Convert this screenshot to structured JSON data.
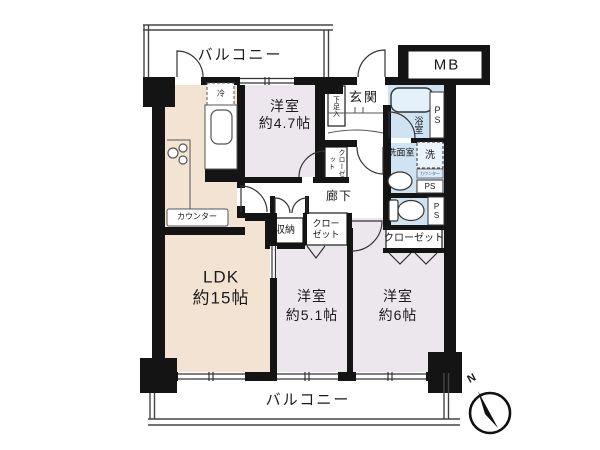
{
  "floorplan": {
    "balcony_top": "バルコニー",
    "balcony_bottom": "バルコニー",
    "meter_box": "MB",
    "entrance": "玄関",
    "shoe_box": "下足入",
    "hallway": "廊下",
    "fridge": "冷",
    "counter": "カウンター",
    "bathroom": "浴室",
    "washroom": "洗面室",
    "washer": "洗",
    "washer_counter": "カウンター",
    "pipe_space_top": "PS",
    "pipe_space_mid": "PS",
    "pipe_space_low": "PS",
    "storage": "収納",
    "closet_47": "クローゼット",
    "closet_51_line1": "クロー",
    "closet_51_line2": "ゼット",
    "closet_6": "クローゼット",
    "rooms": {
      "ldk": {
        "name": "LDK",
        "size": "約15帖"
      },
      "west47": {
        "name": "洋室",
        "size": "約4.7帖"
      },
      "west51": {
        "name": "洋室",
        "size": "約5.1帖"
      },
      "west6": {
        "name": "洋室",
        "size": "約6帖"
      }
    },
    "compass_north": "N",
    "colors": {
      "ldk_floor": "#f3e3d3",
      "bedroom_floor": "#ece7ec",
      "wet_floor": "#cfe3f2",
      "wall": "#141414"
    }
  }
}
